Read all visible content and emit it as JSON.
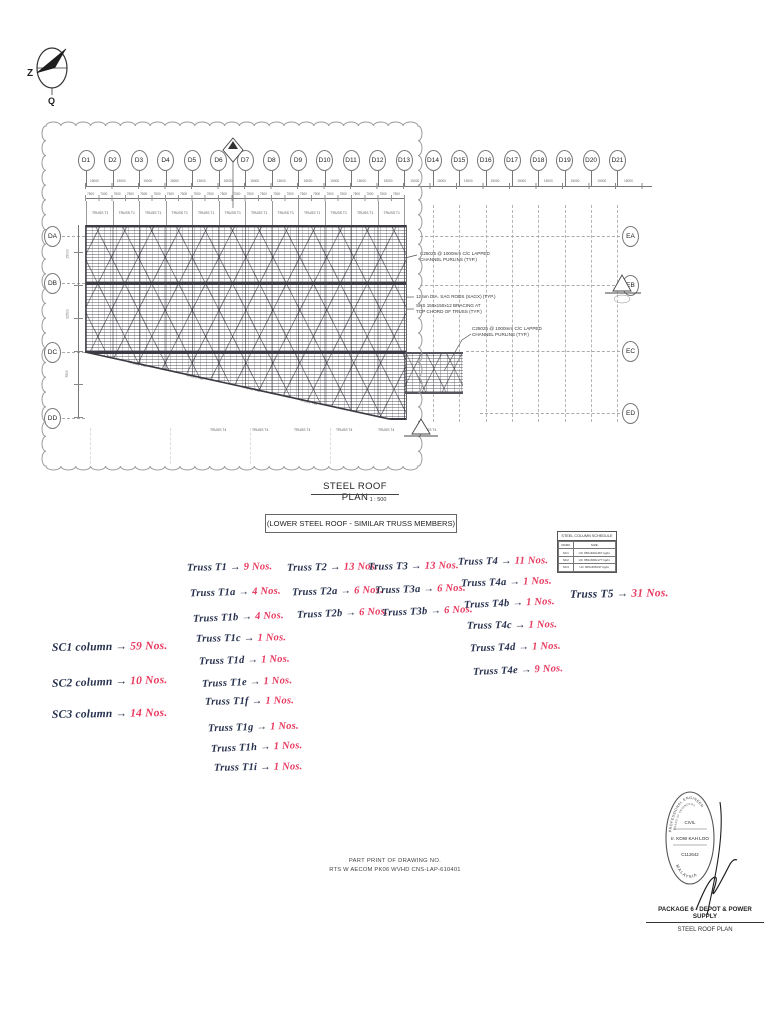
{
  "document": {
    "title": "STEEL ROOF PLAN",
    "scale": "1 : 500",
    "subtitle": "(LOWER STEEL ROOF - SIMILAR TRUSS MEMBERS)"
  },
  "compass": {
    "label_left": "Z",
    "label_bottom": "Q"
  },
  "plan": {
    "grid_top": [
      "D1",
      "D2",
      "D3",
      "D4",
      "D5",
      "D6",
      "D7",
      "D8",
      "D9",
      "D10",
      "D11",
      "D12",
      "D13",
      "D14",
      "D15",
      "D16",
      "D17",
      "D18",
      "D19",
      "D20",
      "D21"
    ],
    "grid_left": [
      "DA",
      "DB",
      "DC",
      "DD"
    ],
    "grid_right": [
      "EA",
      "EB",
      "EC",
      "ED"
    ],
    "dim_bay": "15000",
    "dim_half_bay": "7500",
    "dim_left": [
      "15000",
      "22500",
      "7500"
    ],
    "truss_label_top": "TRUSS T1",
    "truss_label_bottom": "TRUSS T4",
    "truss_labels_diagonal": [
      "TRUSS T4a",
      "TRUSS T4b",
      "TRUSS T4c",
      "TRUSS T4d"
    ],
    "notes": [
      [
        "C25025 @ 1000mm C/C LAPPED",
        "CHANNEL PURLINS (TYP.)"
      ],
      [
        "12mm DIA. SAG RODS (SAGX) (TYP.)"
      ],
      [
        "SHS 150x150x12 BRACING AT",
        "TOP CHORD OF TRUSS (TYP.)"
      ],
      [
        "C25025 @ 1000mm C/C LAPPED",
        "CHANNEL PURLINS (TYP.)"
      ]
    ]
  },
  "schedule": {
    "title": "STEEL COLUMN SCHEDULE",
    "headers": [
      "MARK",
      "SIZE"
    ],
    "rows": [
      [
        "SC1",
        "UC 356x406x467 kg/m"
      ],
      [
        "SC2",
        "UC 356x368x177 kg/m"
      ],
      [
        "SC3",
        "UC 305x305x97 kg/m"
      ]
    ]
  },
  "handwritten": {
    "arrow": "→",
    "ink_dark": "#26304d",
    "ink_red": "#e8395f",
    "truss_columns": [
      {
        "items": [
          [
            "Truss T1",
            "9 Nos."
          ],
          [
            "Truss T1a",
            "4 Nos."
          ],
          [
            "Truss T1b",
            "4 Nos."
          ],
          [
            "Truss T1c",
            "1 Nos."
          ],
          [
            "Truss T1d",
            "1 Nos."
          ],
          [
            "Truss T1e",
            "1 Nos."
          ],
          [
            "Truss T1f",
            "1 Nos."
          ],
          [
            "Truss T1g",
            "1 Nos."
          ],
          [
            "Truss T1h",
            "1 Nos."
          ],
          [
            "Truss T1i",
            "1 Nos."
          ]
        ]
      },
      {
        "items": [
          [
            "Truss T2",
            "13 Nos."
          ],
          [
            "Truss T2a",
            "6 Nos."
          ],
          [
            "Truss T2b",
            "6 Nos."
          ]
        ]
      },
      {
        "items": [
          [
            "Truss T3",
            "13 Nos."
          ],
          [
            "Truss T3a",
            "6 Nos."
          ],
          [
            "Truss T3b",
            "6 Nos."
          ]
        ]
      },
      {
        "items": [
          [
            "Truss T4",
            "11 Nos."
          ],
          [
            "Truss T4a",
            "1 Nos."
          ],
          [
            "Truss T4b",
            "1 Nos."
          ],
          [
            "Truss T4c",
            "1 Nos."
          ],
          [
            "Truss T4d",
            "1 Nos."
          ],
          [
            "Truss T4e",
            "9 Nos."
          ]
        ]
      },
      {
        "items": [
          [
            "Truss T5",
            "31 Nos."
          ]
        ]
      }
    ],
    "column_counts": [
      [
        "SC1 column",
        "59 Nos."
      ],
      [
        "SC2 column",
        "10 Nos."
      ],
      [
        "SC3 column",
        "14 Nos."
      ]
    ]
  },
  "footer": {
    "line1": "PART PRINT OF DRAWING NO.",
    "line2": "RTS W AECOM PK06 WVHD CNS-LAP-610401"
  },
  "stamp": {
    "arc_top": "PROFESSIONAL ENGINEER",
    "arc_inner": "BOARD OF ENGINEERS",
    "discipline": "CIVIL",
    "name": "Ir. KOW KAH LOO",
    "reg_no": "C112642",
    "arc_bottom": "MALAYSIA"
  },
  "titleblock": {
    "package": "PACKAGE 6 - DEPOT & POWER SUPPLY",
    "drawing": "STEEL ROOF PLAN"
  }
}
